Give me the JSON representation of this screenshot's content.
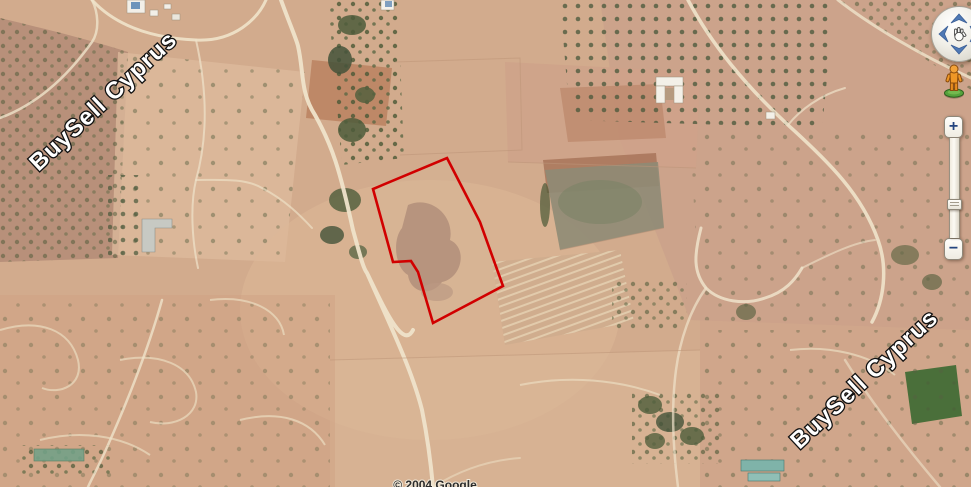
{
  "map": {
    "view_type": "satellite-imagery",
    "watermark_text": "BuySell Cyprus",
    "copyright_text": "© 2004 Google"
  },
  "parcel": {
    "outline_points": "447,158 480,222 503,286 433,323 418,272 411,261 393,262 373,189",
    "outline_color": "#d10000"
  },
  "controls": {
    "zoom_in_label": "+",
    "zoom_out_label": "−",
    "pan_icons": [
      "chevron-up",
      "chevron-left",
      "hand",
      "chevron-right",
      "chevron-down"
    ],
    "pegman_icon": "street-view-pegman"
  },
  "colors": {
    "terrain_base": "#d2ab8d",
    "road": "#efe3ca",
    "trees_dark_green": "#4e5c3b",
    "field_green": "#3e6a33",
    "field_olive_gray": "#8f8b76",
    "plough_brown": "#b97f5e",
    "control_arrow_blue": "#4f79b5",
    "zoom_glyph_navy": "#24457f",
    "pegman_orange": "#ef9726",
    "pegman_base_green": "#55a23c",
    "watermark_fill": "#ffffff",
    "watermark_outline": "#111111"
  }
}
